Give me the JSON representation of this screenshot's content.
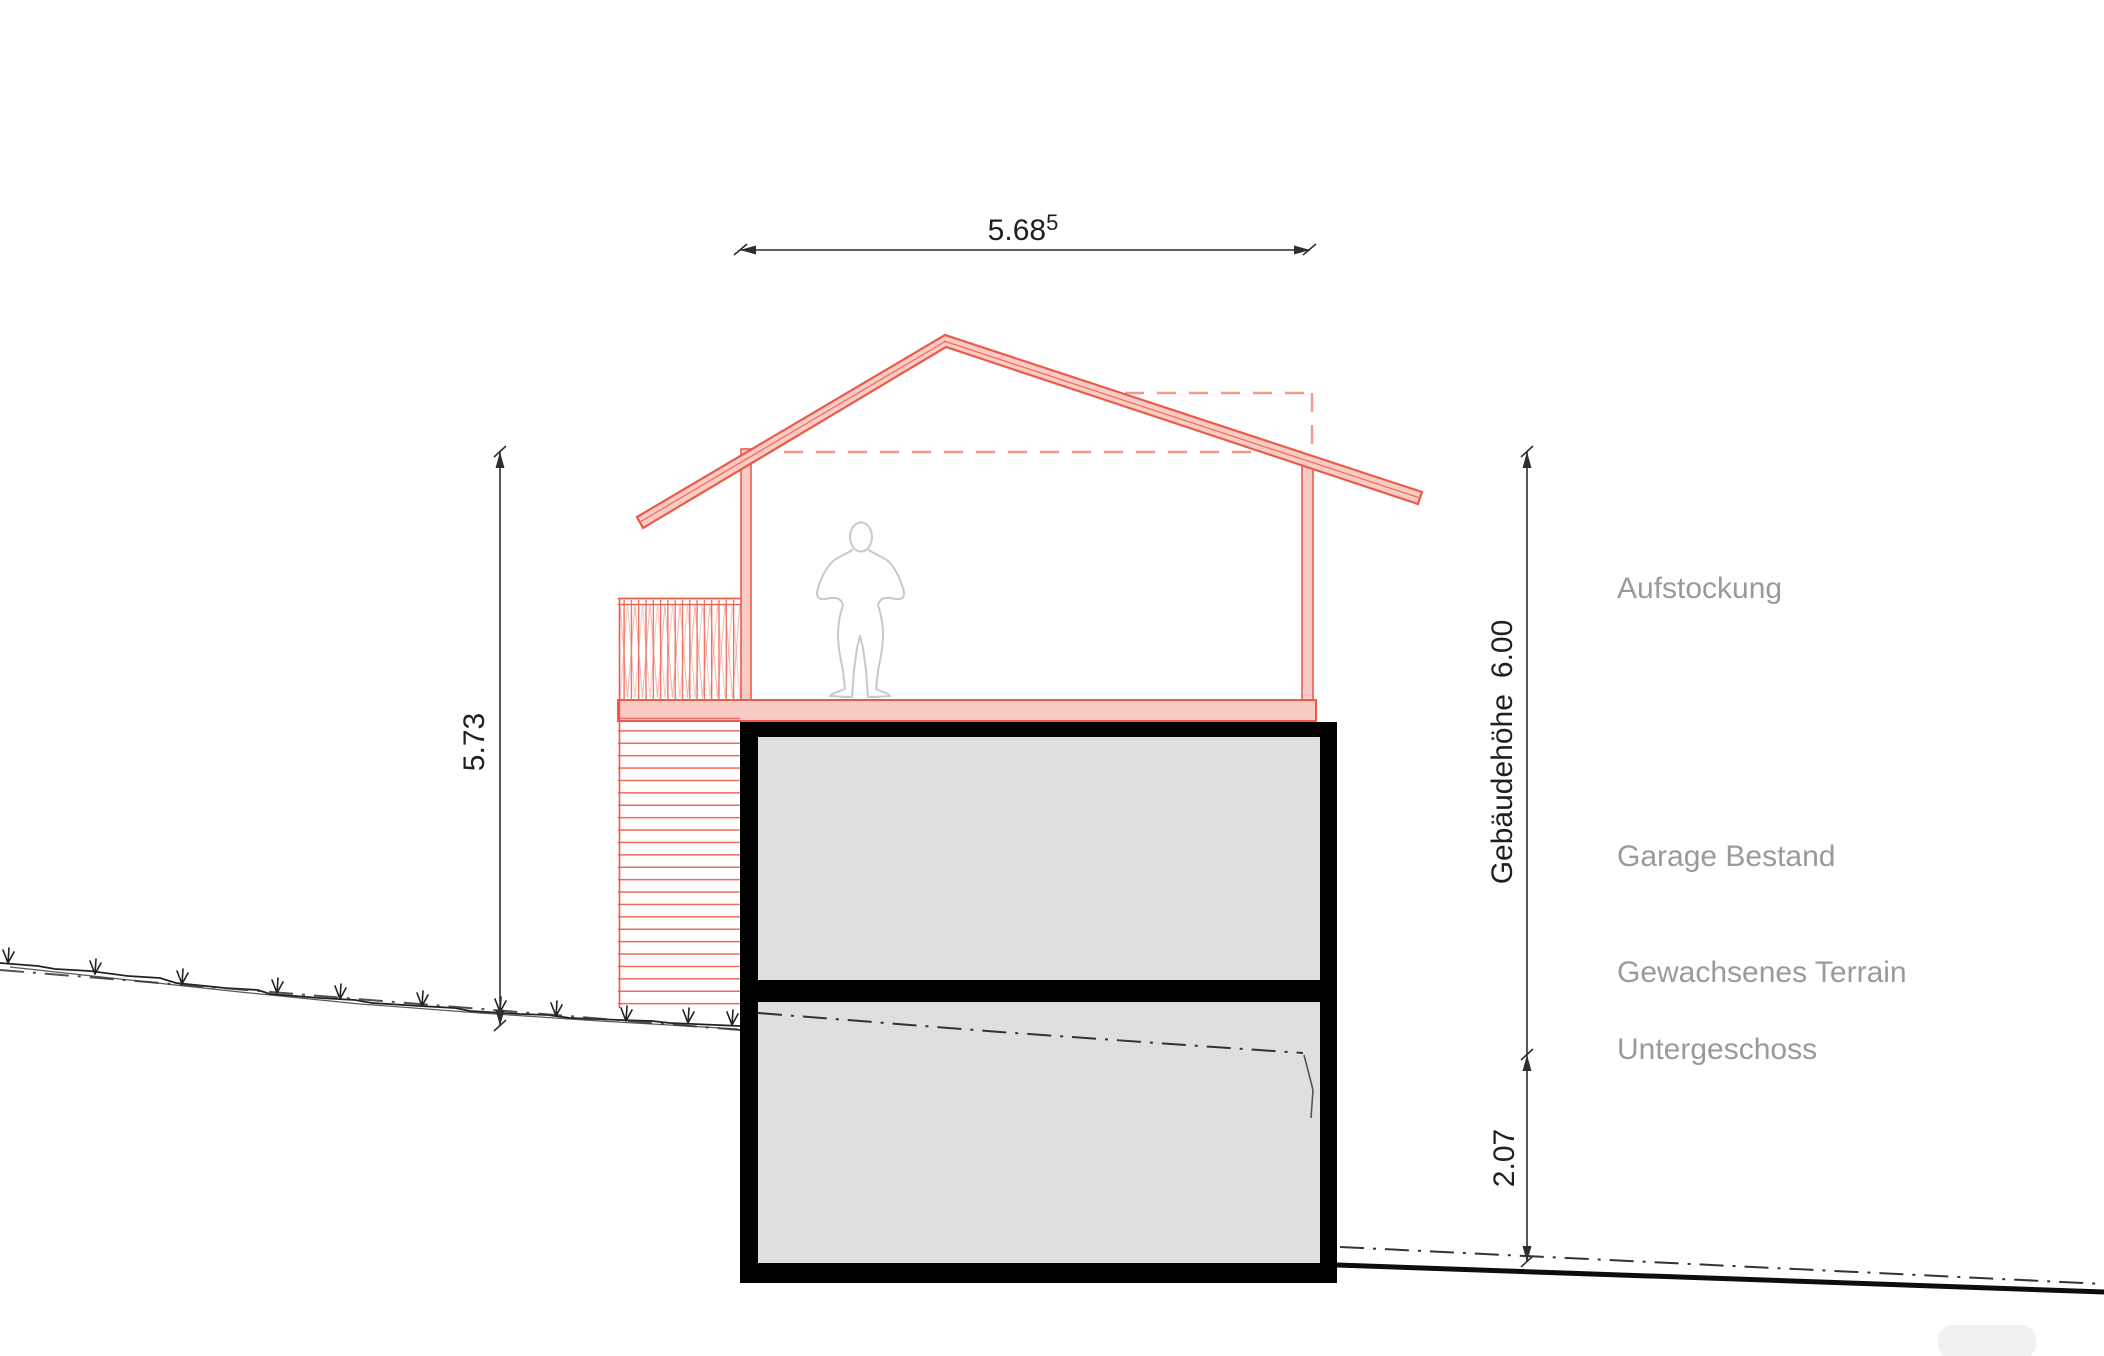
{
  "drawing": {
    "title_hint": "Building section drawing (Aufstockung über Garage)",
    "dimensions": {
      "top_width_value": "5.68",
      "top_width_superscript": "5",
      "left_height": "5.73",
      "building_height_label": "Gebäudehöhe",
      "building_height_value": "6.00",
      "basement_height": "2.07"
    },
    "labels": {
      "aufstockung": "Aufstockung",
      "garage": "Garage Bestand",
      "terrain": "Gewachsenes Terrain",
      "untergeschoss": "Untergeschoss"
    },
    "colors": {
      "addition_outline_red": "#e95c4c",
      "addition_fill_pink": "#f8cbc5",
      "addition_dashed_red": "#f4988c",
      "existing_structure_black": "#000000",
      "existing_fill_gray": "#dfdfdf",
      "label_gray": "#9a9a9a",
      "figure_outline_gray": "#c9c9c9",
      "dimension_black": "#2e2e2e",
      "terrain_line_black": "#222222"
    }
  }
}
